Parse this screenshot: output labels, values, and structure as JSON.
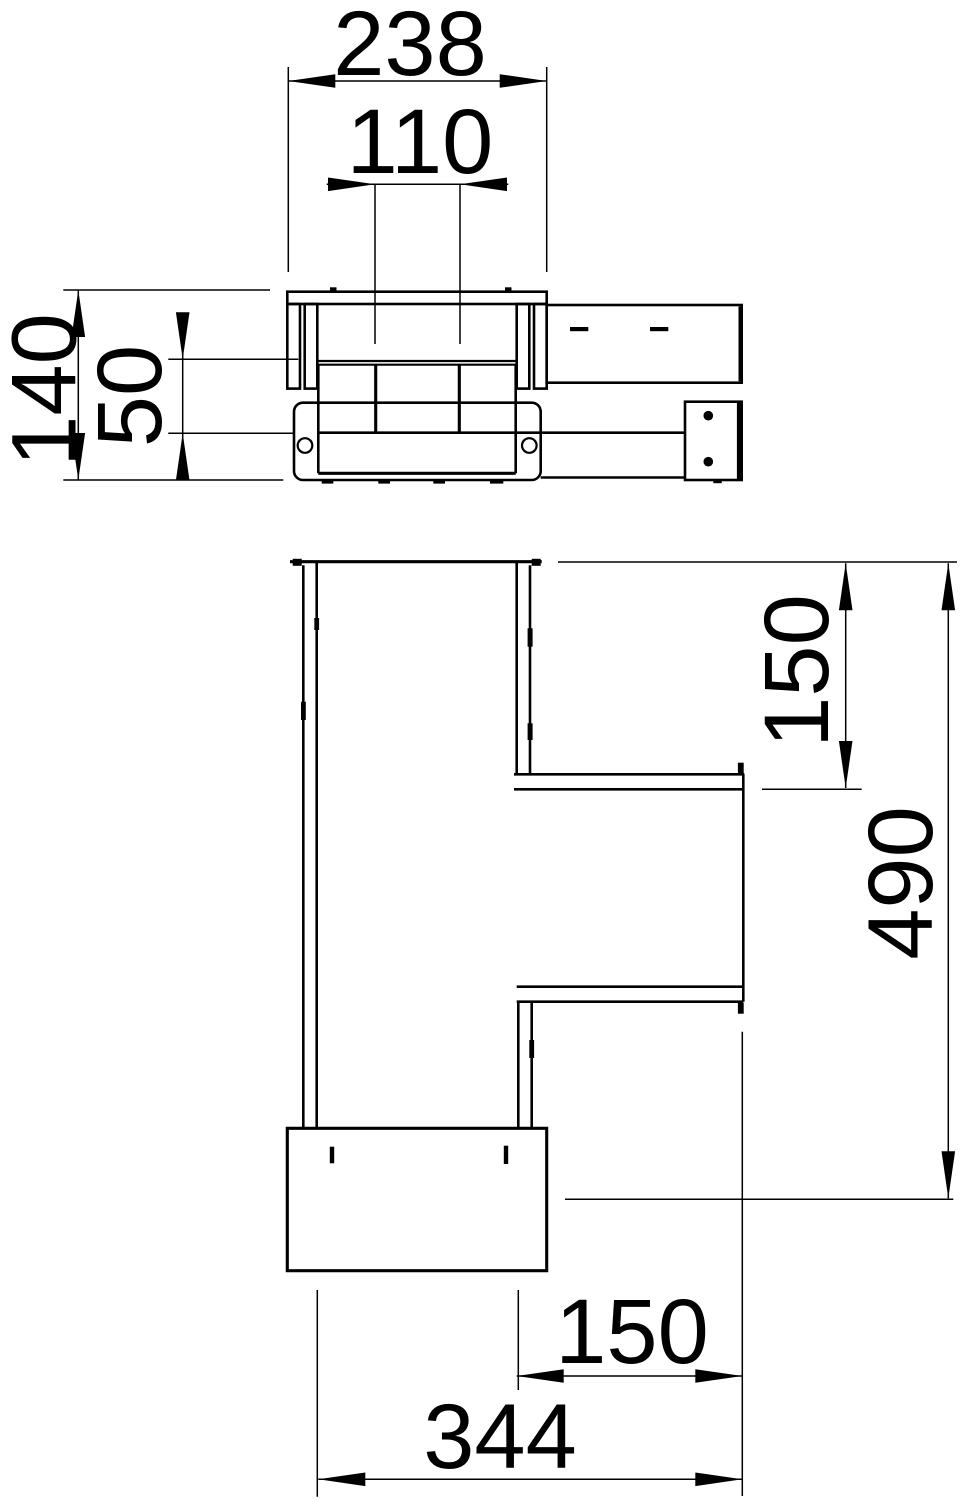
{
  "drawing": {
    "background_color": "#ffffff",
    "line_color": "#000000",
    "views": {
      "elevation": {
        "dims": {
          "overall_width": "238",
          "inner_width": "110",
          "overall_height": "140",
          "inner_height": "50"
        }
      },
      "plan": {
        "dims": {
          "branch_top_offset": "150",
          "overall_length": "490",
          "branch_bottom_width": "150",
          "overall_width": "344"
        }
      }
    }
  }
}
